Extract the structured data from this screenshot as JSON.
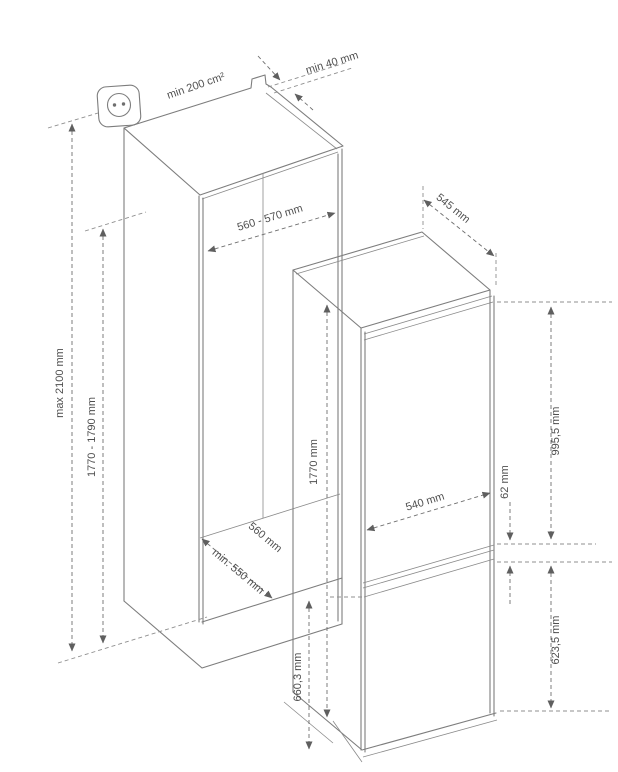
{
  "diagram": {
    "title_semantic": "built-in fridge-freezer installation dimensions",
    "units": "mm",
    "cabinet": {
      "ventilation_area_label": "min 200 cm²",
      "rear_gap_label": "min 40 mm",
      "overall_height_label": "max 2100 mm",
      "niche_height_label": "1770 - 1790 mm",
      "niche_width_label": "560 - 570 mm",
      "floor_depth_label": "560 mm",
      "niche_depth_label": "min. 550 mm"
    },
    "appliance": {
      "depth_label": "545 mm",
      "height_label": "1770 mm",
      "width_label": "540 mm",
      "door_gap_label": "62 mm",
      "upper_door_height_label": "995,5 mm",
      "lower_door_height_label": "623,5 mm",
      "lower_section_height_label": "660,3 mm"
    },
    "icons": {
      "power_socket": "power-socket-icon"
    },
    "colors": {
      "line": "#7d7d7d",
      "dimension_line": "#6f6f6f",
      "text": "#4f4f4f",
      "background": "#ffffff"
    }
  }
}
